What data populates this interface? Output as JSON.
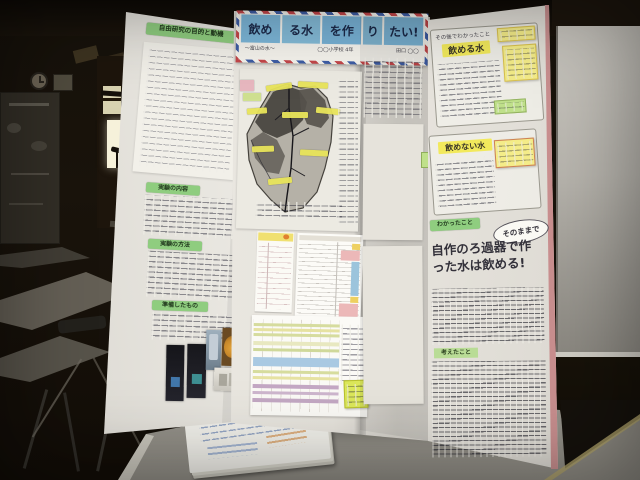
{
  "banner": {
    "title_cards": [
      "飲め",
      "る水",
      "を作",
      "り",
      "たい!"
    ],
    "byline_left": "〜富山の水〜",
    "byline_center": "◯◯小学校 4年",
    "byline_right": "田口 ◯◯"
  },
  "left_panel": {
    "header": "自由研究の目的と動機",
    "section1": "実験の内容",
    "section2": "実験の方法",
    "section3": "準備したもの"
  },
  "right_panel": {
    "intro": "その後でわかったこと",
    "water_ok": "飲める水",
    "water_ng": "飲めない水",
    "found": "わかったこと",
    "callout": "そのままで",
    "statement": "自作のろ過器で作った水は飲める!",
    "thoughts": "考えたこと"
  },
  "colors": {
    "board_white": "#ebe8e2",
    "sticky_yellow": "#f2e95c",
    "header_green": "#8fcd7f",
    "card_blue": "#7db7d9",
    "trim_pink": "#c98f8f",
    "table_blue": "#a9c9e2",
    "table_pink": "#ecb8b8",
    "table_purple": "#c4a8c4",
    "photo_orange": "#c8882a"
  }
}
